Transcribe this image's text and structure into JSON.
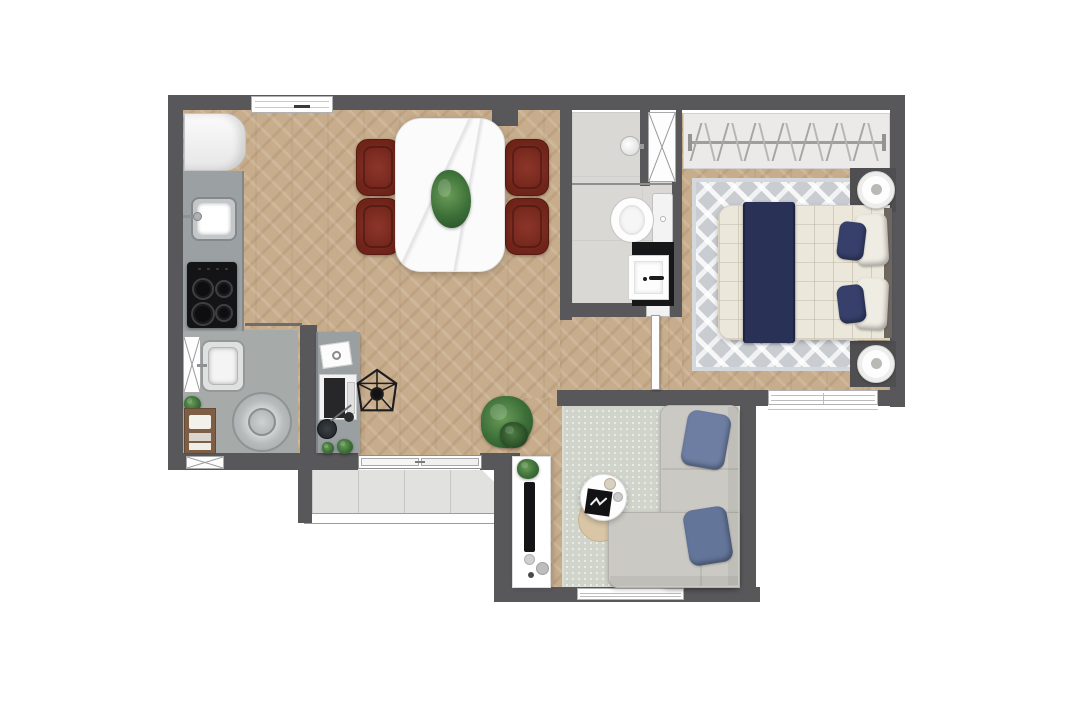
{
  "title": "one-bedroom-apartment-floor-plan",
  "palette": {
    "wall": "#58585b",
    "wood_floor": "#c8ad8c",
    "bathroom_floor": "#dad8d5",
    "laundry_floor": "#a6abaa",
    "balcony_tile": "#e1e1df",
    "bedroom_rug": "#c9ccd1",
    "living_rug": "#d0d4cb",
    "sofa_gray": "#cbc9c3",
    "dining_chair_red": "#7b2a22",
    "bed_runner_navy": "#2a3157",
    "pillow_navy": "#36406b",
    "throw_pillow_blue": "#6d7ea2",
    "counter_gray": "#9ba1a3",
    "appliance_black": "#141416",
    "side_table_beige": "#d9c6a7",
    "plant_green": "#3c6f38"
  },
  "floorplan": {
    "rooms": [
      {
        "id": "kitchen-dining",
        "floor": "herringbone-wood",
        "items": [
          "refrigerator",
          "kitchen-counter",
          "kitchen-sink",
          "cooktop",
          "dining-table",
          "dining-chairs",
          "centerpiece-plant"
        ]
      },
      {
        "id": "home-office-nook",
        "floor": "herringbone-wood",
        "items": [
          "desk",
          "laptop",
          "notebook",
          "office-chair",
          "bowl",
          "desk-plants"
        ]
      },
      {
        "id": "laundry-area",
        "floor": "gray-tile",
        "items": [
          "duct-shaft",
          "utility-sink",
          "washing-machine",
          "towel-shelf",
          "small-plant"
        ]
      },
      {
        "id": "bathroom",
        "floor": "light-gray-tile",
        "items": [
          "shower-head",
          "glass-partition",
          "duct-shaft",
          "toilet",
          "vanity-counter",
          "vanity-sink"
        ]
      },
      {
        "id": "bedroom",
        "floor": "herringbone-wood",
        "items": [
          "closet-rail",
          "clothes-hangers",
          "double-bed",
          "bed-runner",
          "navy-pillows",
          "white-pillows",
          "chevron-rug",
          "round-nightstands"
        ]
      },
      {
        "id": "living-room",
        "floor": "herringbone-wood",
        "items": [
          "area-rug",
          "l-shaped-sofa",
          "throw-pillows",
          "coffee-table",
          "tray",
          "side-table",
          "tv-console",
          "tv",
          "plant"
        ]
      },
      {
        "id": "balcony",
        "floor": "large-tile",
        "items": [
          "sliding-door",
          "parapet"
        ]
      }
    ],
    "openings": [
      "entrance-door",
      "balcony-sliding-door",
      "bathroom-door",
      "bedroom-doorway",
      "laundry-window",
      "bedroom-window",
      "living-room-window"
    ],
    "counts": {
      "dining_chairs": 4,
      "cooktop_burners": 4,
      "closet_hangers": 14,
      "bed_pillows": 4,
      "sofa_throw_pillows": 2,
      "nightstands": 2
    }
  }
}
